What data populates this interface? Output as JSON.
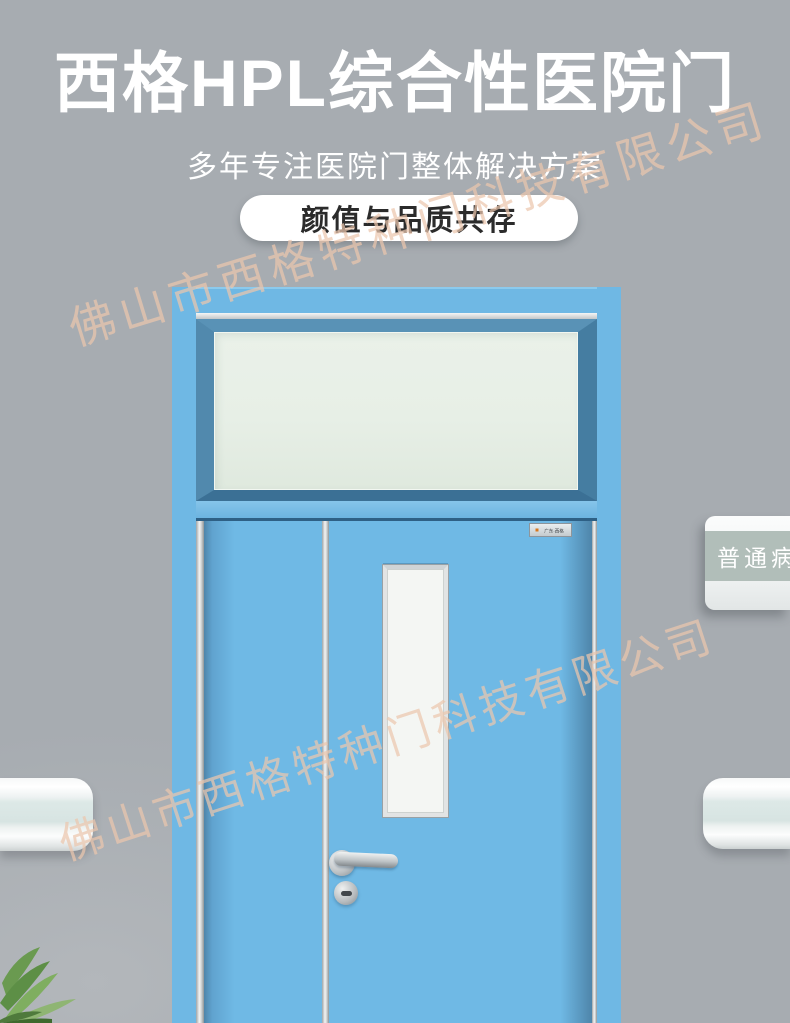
{
  "header": {
    "title": "西格HPL综合性医院门",
    "subtitle": "多年专注医院门整体解决方案",
    "badge": "颜值与品质共存"
  },
  "watermark": {
    "company": "佛山市西格特种门科技有限公司"
  },
  "door": {
    "brand_plate": "广东·西格",
    "sign_label": "普通病房"
  },
  "colors": {
    "wall": "#a7acb1",
    "wall_light": "#b3b7bb",
    "title_color": "#ffffff",
    "badge_bg": "#ffffff",
    "badge_text": "#2b2b2b",
    "door_blue": "#6fb9e5",
    "frame_blue": "#6fb8e4",
    "sash_blue": "#4e86ab",
    "shadow_blue": "#4e85aa",
    "transom_glass": "#e7efe6",
    "vision_glass": "#f4f6f3",
    "sign_band": "#b1beb9",
    "rail_band": "#dde9e7",
    "wm_color": "#ecc7ae",
    "plant_green": "#6a9a50"
  }
}
